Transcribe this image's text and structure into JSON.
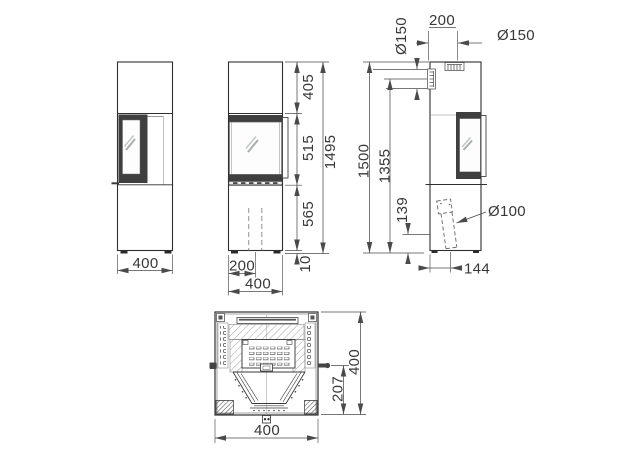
{
  "drawing": {
    "type": "stove-technical-drawing",
    "views": {
      "front_left": {
        "width": "400"
      },
      "front": {
        "top_section": "405",
        "window_section": "515",
        "bottom_section": "565",
        "total_height": "1495",
        "feet_height": "10",
        "center_offset": "200",
        "width": "400"
      },
      "side": {
        "flue_offset": "200",
        "top_flue_diameter": "Ø150",
        "rear_flue_diameter": "Ø150",
        "total_height": "1500",
        "rear_flue_height": "1355",
        "intake_height": "139",
        "intake_diameter": "Ø100",
        "intake_offset": "144"
      },
      "top": {
        "depth": "400",
        "door_offset": "207",
        "width": "400"
      }
    }
  }
}
